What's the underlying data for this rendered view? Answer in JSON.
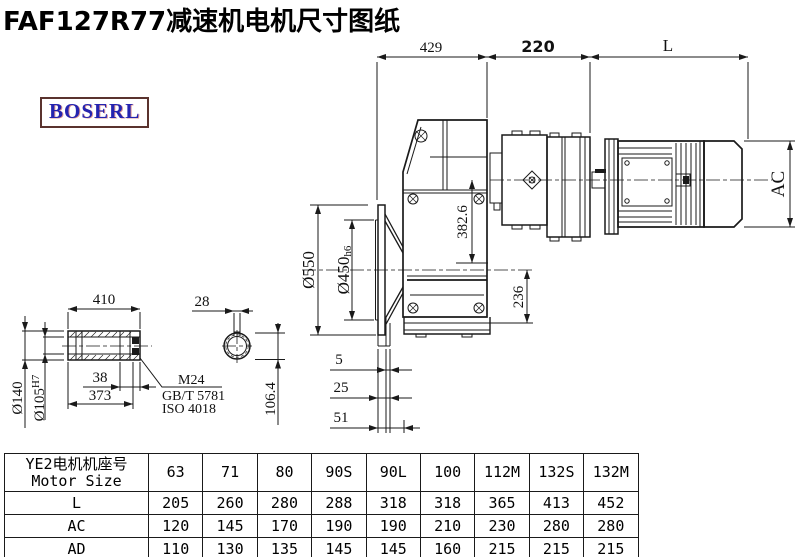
{
  "page": {
    "title_text": "FAF127R77减速机电机尺寸图纸"
  },
  "logo": {
    "text": "BOSERL"
  },
  "drawing": {
    "top_dims": {
      "d429": "429",
      "d220": "220",
      "dL": "L"
    },
    "flange_dims": {
      "od": "Ø550",
      "spigot": "Ø450",
      "spigot_tol": "h6"
    },
    "height_dims": {
      "axis_height": "382.6",
      "base_height": "236"
    },
    "offset_dims": {
      "d5": "5",
      "d25": "25",
      "d51": "51"
    },
    "motor_dims": {
      "ac": "AC"
    },
    "shaft_dims": {
      "length": "410",
      "od": "Ø140",
      "bore": "Ø105",
      "bore_tol": "H7",
      "d38": "38",
      "d373": "373",
      "key_w": "28",
      "key_h": "106.4"
    },
    "note": {
      "line1": "M24",
      "line2": "GB/T 5781",
      "line3": "ISO 4018"
    }
  },
  "table": {
    "header_cn": "YE2电机机座号",
    "header_en": "Motor Size",
    "sizes": [
      "63",
      "71",
      "80",
      "90S",
      "90L",
      "100",
      "112M",
      "132S",
      "132M"
    ],
    "rows": [
      {
        "label": "L",
        "values": [
          "205",
          "260",
          "280",
          "288",
          "318",
          "318",
          "365",
          "413",
          "452"
        ]
      },
      {
        "label": "AC",
        "values": [
          "120",
          "145",
          "170",
          "190",
          "190",
          "210",
          "230",
          "280",
          "280"
        ]
      },
      {
        "label": "AD",
        "values": [
          "110",
          "130",
          "135",
          "145",
          "145",
          "160",
          "215",
          "215",
          "215"
        ]
      }
    ]
  }
}
